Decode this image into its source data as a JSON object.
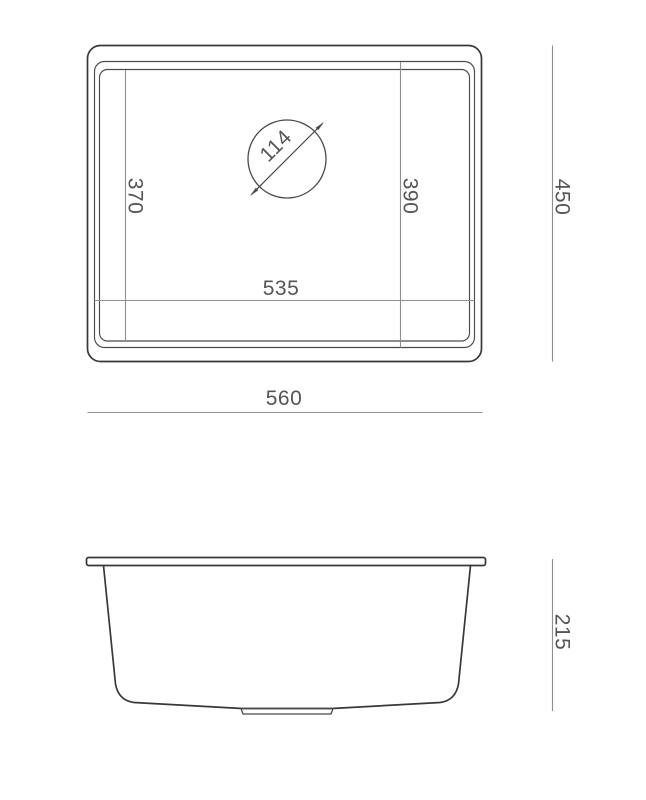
{
  "drawing": {
    "colors": {
      "background": "#ffffff",
      "outline": "#383838",
      "dimension_line": "#8f8f8f",
      "dimension_text": "#555555"
    },
    "top_view": {
      "bowl_depth_left": "370",
      "bowl_depth_right": "390",
      "bowl_width": "535",
      "overall_width": "560",
      "overall_depth": "450",
      "drain_diameter": "114"
    },
    "side_view": {
      "overall_height": "215"
    }
  }
}
